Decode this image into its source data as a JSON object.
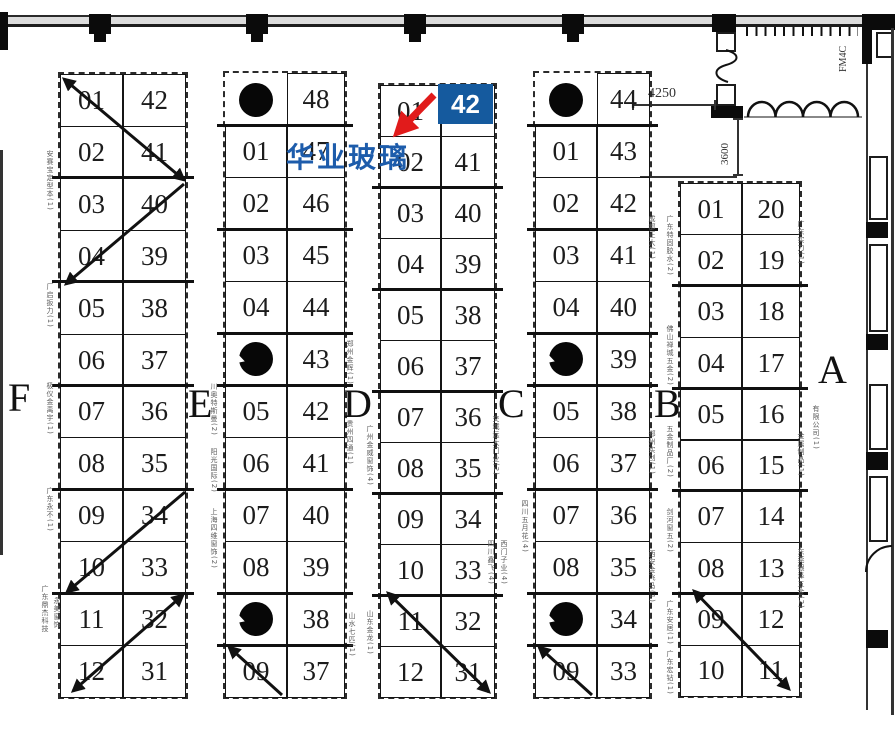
{
  "plan": {
    "highlight": {
      "company_name": "华业玻璃",
      "booth_number": "42",
      "badge_color": "#155a9e",
      "name_color": "#1d5cab",
      "arrow_color": "#e11b1b"
    },
    "annotations": {
      "dim_top": "4250",
      "dim_side": "3600",
      "door_label": "FM4C"
    },
    "sections": [
      {
        "letter": "F",
        "rows": [
          [
            "01",
            "42"
          ],
          [
            "02",
            "41"
          ],
          [
            "03",
            "40"
          ],
          [
            "04",
            "39"
          ],
          [
            "05",
            "38"
          ],
          [
            "06",
            "37"
          ],
          [
            "07",
            "36"
          ],
          [
            "08",
            "35"
          ],
          [
            "09",
            "34"
          ],
          [
            "10",
            "33"
          ],
          [
            "11",
            "32"
          ],
          [
            "12",
            "31"
          ]
        ]
      },
      {
        "letter": "E",
        "rows": [
          [
            "",
            "48"
          ],
          [
            "01",
            "47"
          ],
          [
            "02",
            "46"
          ],
          [
            "03",
            "45"
          ],
          [
            "04",
            "44"
          ],
          [
            "",
            "43"
          ],
          [
            "05",
            "42"
          ],
          [
            "06",
            "41"
          ],
          [
            "07",
            "40"
          ],
          [
            "08",
            "39"
          ],
          [
            "",
            "38"
          ],
          [
            "09",
            "37"
          ]
        ]
      },
      {
        "letter": "D",
        "rows": [
          [
            "01",
            "42"
          ],
          [
            "02",
            "41"
          ],
          [
            "03",
            "40"
          ],
          [
            "04",
            "39"
          ],
          [
            "05",
            "38"
          ],
          [
            "06",
            "37"
          ],
          [
            "07",
            "36"
          ],
          [
            "08",
            "35"
          ],
          [
            "09",
            "34"
          ],
          [
            "10",
            "33"
          ],
          [
            "11",
            "32"
          ],
          [
            "12",
            "31"
          ]
        ],
        "highlight_cell": [
          0,
          1
        ]
      },
      {
        "letter": "C",
        "rows": [
          [
            "",
            "44"
          ],
          [
            "01",
            "43"
          ],
          [
            "02",
            "42"
          ],
          [
            "03",
            "41"
          ],
          [
            "04",
            "40"
          ],
          [
            "",
            "39"
          ],
          [
            "05",
            "38"
          ],
          [
            "06",
            "37"
          ],
          [
            "07",
            "36"
          ],
          [
            "08",
            "35"
          ],
          [
            "",
            "34"
          ],
          [
            "09",
            "33"
          ]
        ]
      },
      {
        "letter": "B",
        "rows": [
          [
            "01",
            "20"
          ],
          [
            "02",
            "19"
          ],
          [
            "03",
            "18"
          ],
          [
            "04",
            "17"
          ],
          [
            "05",
            "16"
          ],
          [
            "06",
            "15"
          ],
          [
            "07",
            "14"
          ],
          [
            "08",
            "13"
          ],
          [
            "09",
            "12"
          ],
          [
            "10",
            "11"
          ]
        ]
      },
      {
        "letter": "A",
        "rows": []
      }
    ],
    "side_labels": [
      {
        "x": 50,
        "y": 150,
        "text": "安赛宝定型本(1)"
      },
      {
        "x": 50,
        "y": 283,
        "text": "厂启扳力(1)"
      },
      {
        "x": 50,
        "y": 382,
        "text": "极仪金禹宇(1)"
      },
      {
        "x": 50,
        "y": 487,
        "text": "广东永不(1)"
      },
      {
        "x": 45,
        "y": 585,
        "text": "广东鼎杰科技"
      },
      {
        "x": 57,
        "y": 597,
        "text": "永美窗饰"
      },
      {
        "x": 214,
        "y": 383,
        "text": "川奥特斯曼(2)"
      },
      {
        "x": 214,
        "y": 448,
        "text": "阳光国际(2)"
      },
      {
        "x": 214,
        "y": 508,
        "text": "上海四维窗饰(2)"
      },
      {
        "x": 350,
        "y": 340,
        "text": "郑州金辉(1)"
      },
      {
        "x": 350,
        "y": 420,
        "text": "贵州四通(1)"
      },
      {
        "x": 352,
        "y": 612,
        "text": "山水七匹(1)"
      },
      {
        "x": 370,
        "y": 425,
        "text": "广州金威窗饰(4)"
      },
      {
        "x": 370,
        "y": 610,
        "text": "山东金龙(1)"
      },
      {
        "x": 496,
        "y": 415,
        "text": "交城远大门业(2)"
      },
      {
        "x": 491,
        "y": 540,
        "text": "四川鑫飞(4)"
      },
      {
        "x": 504,
        "y": 540,
        "text": "西门子业(4)"
      },
      {
        "x": 525,
        "y": 500,
        "text": "四川五月花(4)"
      },
      {
        "x": 652,
        "y": 215,
        "text": "成都正大(1)"
      },
      {
        "x": 652,
        "y": 430,
        "text": "郑州实创(1)"
      },
      {
        "x": 652,
        "y": 550,
        "text": "西安金飞马(1)"
      },
      {
        "x": 670,
        "y": 215,
        "text": "广东特固胶水(2)"
      },
      {
        "x": 670,
        "y": 325,
        "text": "佛山禅城五金(2)"
      },
      {
        "x": 670,
        "y": 425,
        "text": "五金制品厂(2)"
      },
      {
        "x": 670,
        "y": 508,
        "text": "剑河窗五(2)"
      },
      {
        "x": 670,
        "y": 600,
        "text": "广东安居(1)"
      },
      {
        "x": 670,
        "y": 650,
        "text": "广东宏钻(1)"
      },
      {
        "x": 801,
        "y": 220,
        "text": "广东实力(1)"
      },
      {
        "x": 801,
        "y": 432,
        "text": "金属制品(1)"
      },
      {
        "x": 801,
        "y": 548,
        "text": "东莞银泽五金(2)"
      },
      {
        "x": 816,
        "y": 405,
        "text": "有限公司(1)"
      }
    ]
  }
}
